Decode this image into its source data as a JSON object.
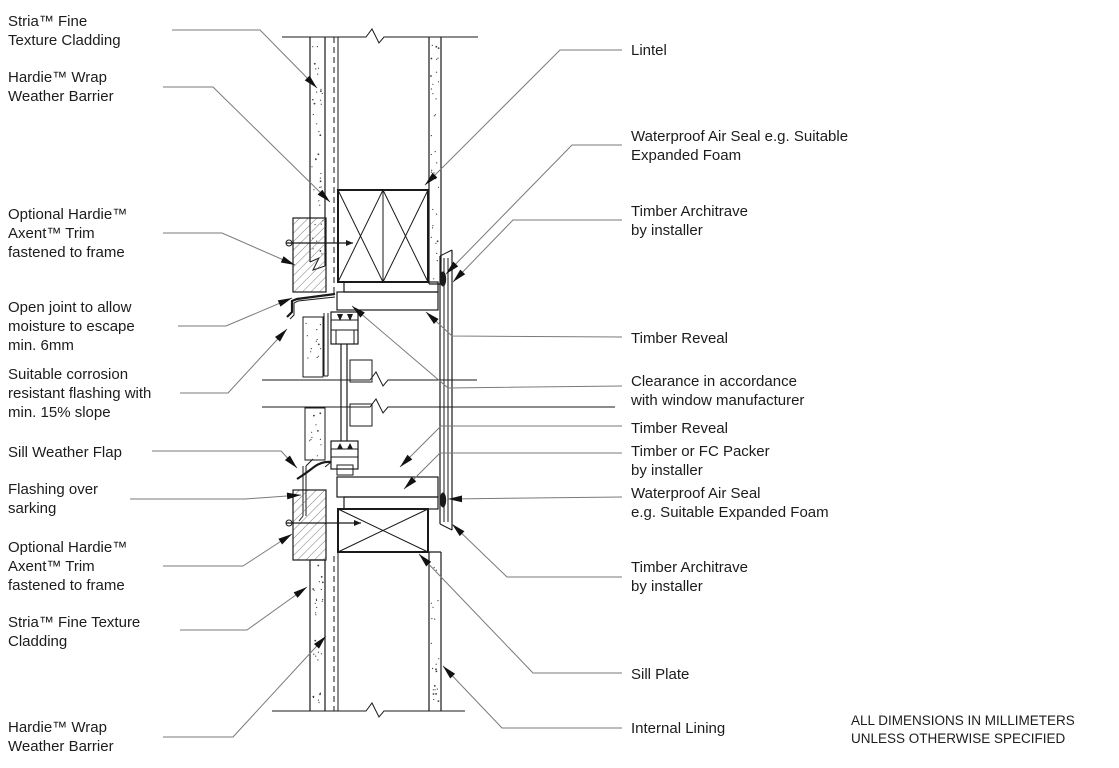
{
  "title": "Window head and sill cladding detail",
  "colors": {
    "background": "#ffffff",
    "line": "#1a1a1a",
    "leader": "#7a7a7a",
    "text": "#1c1c1c"
  },
  "labels_left": [
    {
      "text": "Stria™ Fine\nTexture Cladding"
    },
    {
      "text": "Hardie™ Wrap\nWeather Barrier"
    },
    {
      "text": "Optional Hardie™\nAxent™ Trim\nfastened to frame"
    },
    {
      "text": "Open joint to allow\nmoisture to escape\nmin. 6mm"
    },
    {
      "text": "Suitable corrosion\nresistant flashing with\nmin. 15% slope"
    },
    {
      "text": "Sill Weather Flap"
    },
    {
      "text": "Flashing over\nsarking"
    },
    {
      "text": "Optional Hardie™\nAxent™ Trim\nfastened to frame"
    },
    {
      "text": "Stria™ Fine Texture\nCladding"
    },
    {
      "text": "Hardie™ Wrap\nWeather Barrier"
    }
  ],
  "labels_right": [
    {
      "text": "Lintel"
    },
    {
      "text": "Waterproof Air Seal e.g. Suitable\nExpanded Foam"
    },
    {
      "text": "Timber Architrave\nby installer"
    },
    {
      "text": "Timber Reveal"
    },
    {
      "text": "Clearance in accordance\nwith window manufacturer"
    },
    {
      "text": "Timber Reveal"
    },
    {
      "text": "Timber or FC Packer\nby installer"
    },
    {
      "text": "Waterproof Air Seal\ne.g. Suitable Expanded Foam"
    },
    {
      "text": "Timber Architrave\nby installer"
    },
    {
      "text": "Sill Plate"
    },
    {
      "text": "Internal Lining"
    }
  ],
  "note": "ALL DIMENSIONS IN MILLIMETERS\nUNLESS OTHERWISE SPECIFIED"
}
